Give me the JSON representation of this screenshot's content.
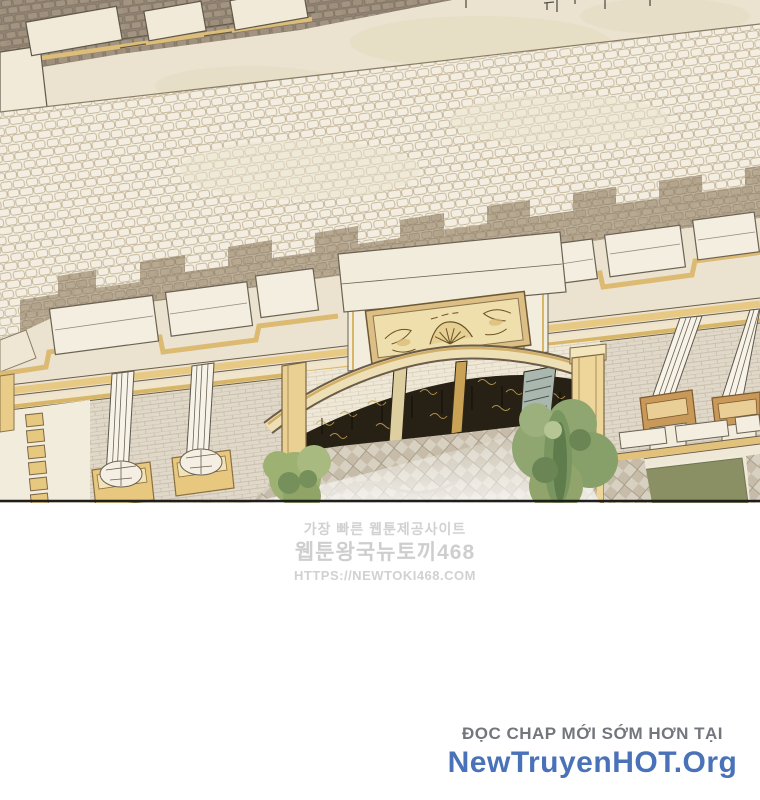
{
  "page": {
    "background_color": "#ffffff"
  },
  "illustration": {
    "description": "Aerial isometric manhwa panel of a palace forecourt: cobblestone plaza, crenellated parapet with gold trim, golden pediment plaque over an arched wrought-iron gate, fluted columns, checkered driveway, trees and an olive lawn",
    "palette": {
      "terrace_cream": "#ebe3d0",
      "plaza_stone": "#f3eee1",
      "stone_outline": "#bcac8e",
      "shadow_taupe": "#b2a28a",
      "roof_taupe": "#8e8376",
      "gold_trim": "#e2c27a",
      "gold_dark": "#b98a45",
      "wall_brick": "#dcd4c5",
      "iron_dark": "#262015",
      "tree_green": "#8fa671",
      "lawn_olive": "#8a9064",
      "panel_border": "#1e1e1e"
    }
  },
  "watermark": {
    "tagline": "가장 빠른 웹툰제공사이트",
    "site_name": "웹툰왕국뉴토끼468",
    "site_url": "HTTPS://NEWTOKI468.COM",
    "text_color": "#c9c9c9"
  },
  "footer": {
    "notice": "ĐỌC CHAP MỚI SỚM HƠN TẠI",
    "site_name": "NewTruyenHOT.Org",
    "notice_color": "#73777d",
    "site_color": "#4a72b8"
  }
}
